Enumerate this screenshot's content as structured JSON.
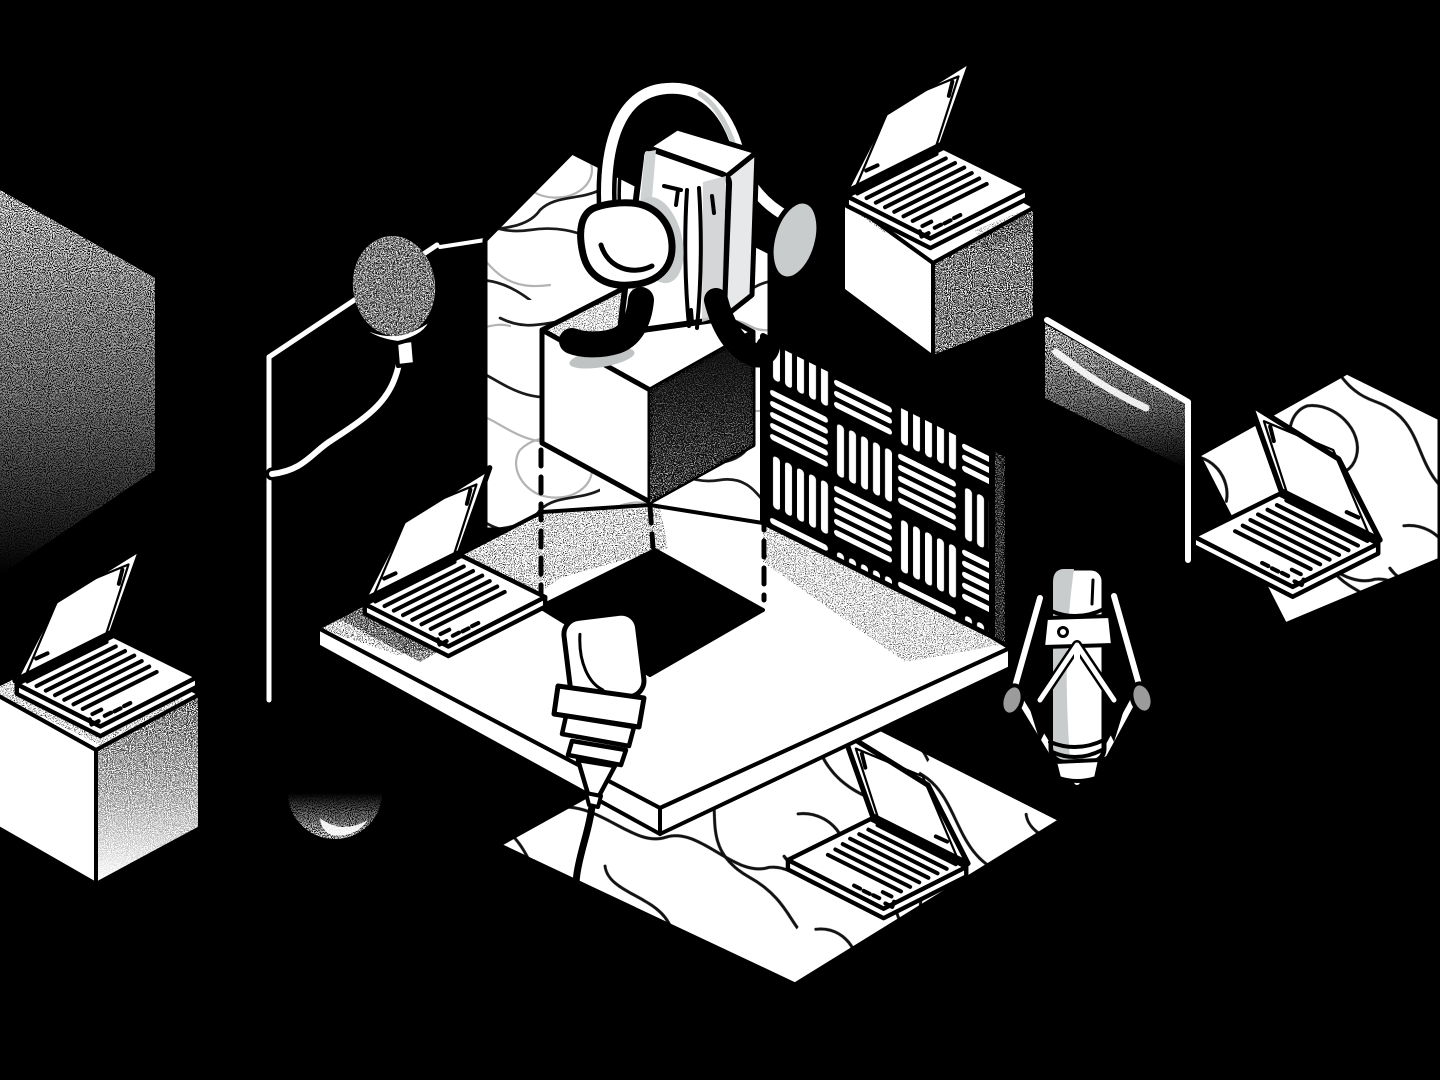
{
  "scene": {
    "title": "Isometric podcast recording studio illustration",
    "style": "black-and-white stippled isometric vector art",
    "background_color": "#000000"
  },
  "palette": {
    "background": "#000000",
    "ink": "#101010",
    "paper": "#ffffff",
    "soft_shadow": "#c9cccd",
    "panel_gray": "#d6d9da",
    "knob_gray": "#9b9b9b",
    "contour_dark": "#1a1a1a",
    "contour_light": "#b3b3b3"
  },
  "objects": [
    {
      "name": "headphone-character",
      "desc": "speaker box figure wearing large headphones, sitting on floating cube"
    },
    {
      "name": "floating-cube",
      "desc": "white cube suspended over square hole with dashed drop lines"
    },
    {
      "name": "main-platform",
      "desc": "white isometric platform with square cutout"
    },
    {
      "name": "acoustic-foam-wall",
      "desc": "checkerboard of striped acoustic panels"
    },
    {
      "name": "topographic-wall",
      "desc": "back wall with contour-line texture"
    },
    {
      "name": "pop-filter-mic",
      "desc": "foam windscreen microphone on gooseneck arm"
    },
    {
      "name": "condenser-mic-center",
      "desc": "hanging condenser microphone with cable"
    },
    {
      "name": "condenser-mic-right",
      "desc": "studio condenser microphone in shock mount"
    },
    {
      "name": "laptop-platform",
      "desc": "open laptop on main platform"
    },
    {
      "name": "laptop-top-right",
      "desc": "open laptop on pedestal cube"
    },
    {
      "name": "laptop-bottom-left",
      "desc": "open laptop on pedestal cube"
    },
    {
      "name": "laptop-bottom-center",
      "desc": "open laptop on topographic floor tile"
    },
    {
      "name": "laptop-far-right",
      "desc": "open laptop on topographic floor tile"
    },
    {
      "name": "topo-floor-tiles",
      "desc": "diamond floor tiles with contour pattern"
    },
    {
      "name": "stipple-wall",
      "desc": "noise-shaded wall plane, far left"
    },
    {
      "name": "stipple-dome",
      "desc": "small speckled dome, lower left"
    }
  ]
}
